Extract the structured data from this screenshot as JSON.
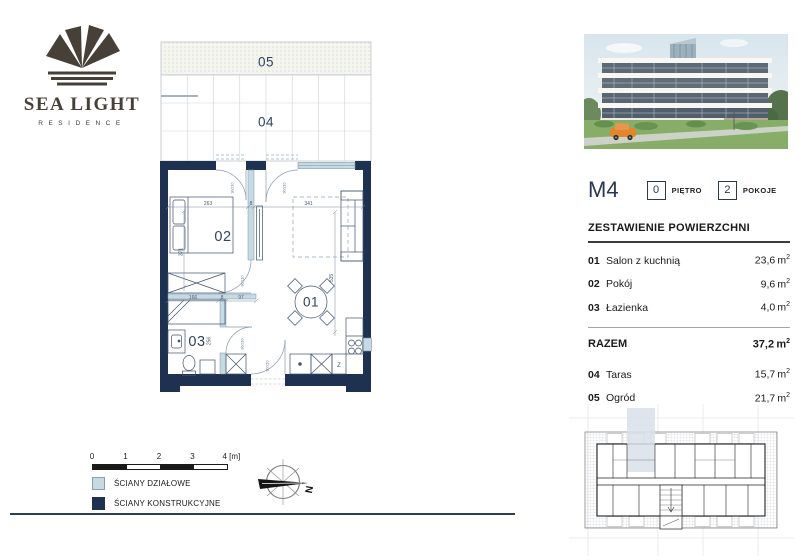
{
  "brand": {
    "name": "SEA LIGHT",
    "subtitle": "RESIDENCE"
  },
  "unit": {
    "id": "M4",
    "floor_value": "0",
    "floor_label": "PIĘTRO",
    "rooms_value": "2",
    "rooms_label": "POKOJE"
  },
  "units": {
    "m": "m",
    "sup": "2"
  },
  "area_table": {
    "title": "ZESTAWIENIE POWIERZCHNI",
    "rows": [
      {
        "no": "01",
        "name": "Salon z kuchnią",
        "value": "23,6"
      },
      {
        "no": "02",
        "name": "Pokój",
        "value": "9,6"
      },
      {
        "no": "03",
        "name": "Łazienka",
        "value": "4,0"
      }
    ],
    "total": {
      "label": "RAZEM",
      "value": "37,2"
    },
    "outdoor_rows": [
      {
        "no": "04",
        "name": "Taras",
        "value": "15,7"
      },
      {
        "no": "05",
        "name": "Ogród",
        "value": "21,7"
      }
    ]
  },
  "floorplan": {
    "labels": {
      "r01": "01",
      "r02": "02",
      "r03": "03",
      "r04": "04",
      "r05": "05"
    },
    "dims": {
      "d263": "263",
      "d8": "8",
      "d341": "341",
      "d371": "371",
      "d535": "535",
      "d166": "166",
      "d97": "97",
      "d256": "256"
    },
    "doors": {
      "standard": "90/210",
      "narrow": "80/210"
    },
    "fridge": "Z"
  },
  "legend": {
    "items": [
      {
        "label": "ŚCIANY DZIAŁOWE",
        "color": "#c5dae3"
      },
      {
        "label": "ŚCIANY KONSTRUKCYJNE",
        "color": "#1e3151"
      }
    ]
  },
  "scalebar": {
    "labels": [
      "0",
      "1",
      "2",
      "3",
      "4 [m]"
    ]
  },
  "compass": {
    "north": "N"
  },
  "colors": {
    "wall_structural": "#1e3151",
    "wall_partition": "#c5dae3",
    "accent_navy": "#2c3850"
  }
}
